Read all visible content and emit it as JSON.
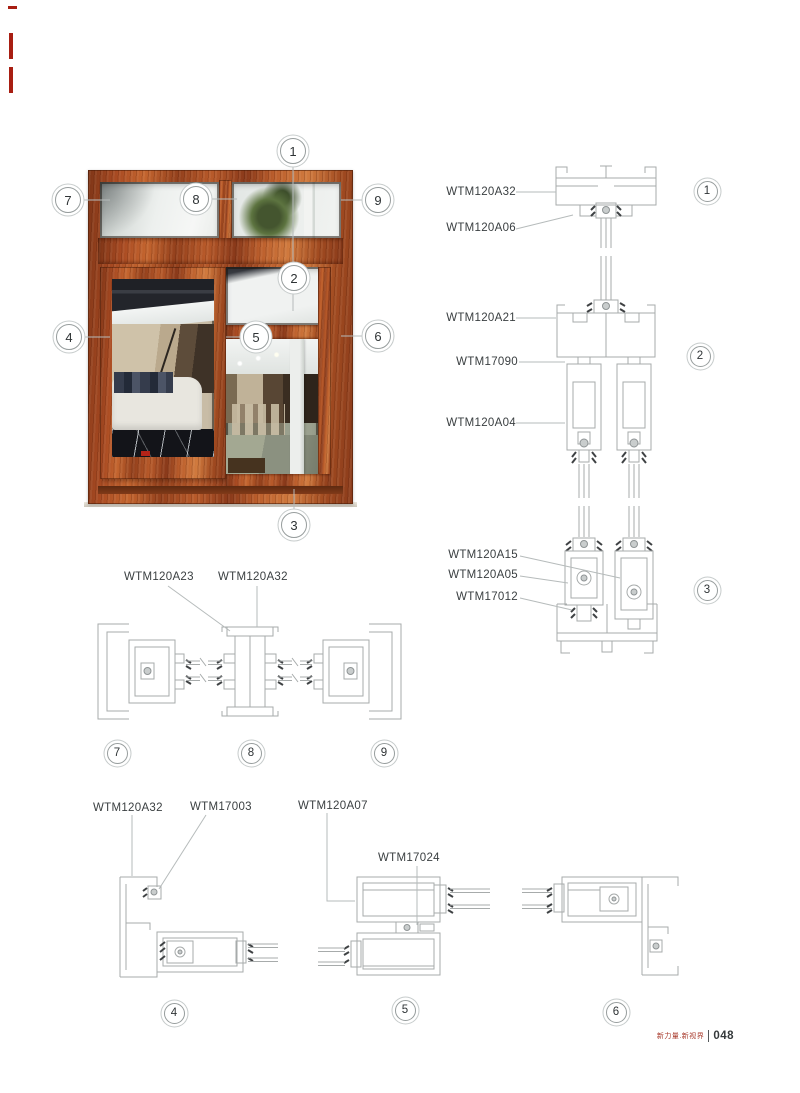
{
  "page": {
    "footer": {
      "brand": "新力量.新视界",
      "separator": "|",
      "page_number": "048"
    }
  },
  "window_photo": {
    "callouts": [
      "1",
      "2",
      "3",
      "4",
      "5",
      "6",
      "7",
      "8",
      "9"
    ]
  },
  "detail_sections": {
    "right_column": [
      {
        "callout": "1",
        "labels": [
          "WTM120A32",
          "WTM120A06"
        ]
      },
      {
        "callout": "2",
        "labels": [
          "WTM120A21",
          "WTM17090",
          "WTM120A04"
        ]
      },
      {
        "callout": "3",
        "labels": [
          "WTM120A15",
          "WTM120A05",
          "WTM17012"
        ]
      }
    ],
    "middle_row": {
      "labels": [
        "WTM120A23",
        "WTM120A32"
      ],
      "callouts": [
        "7",
        "8",
        "9"
      ]
    },
    "bottom_row": {
      "labels": [
        "WTM120A32",
        "WTM17003",
        "WTM120A07",
        "WTM17024"
      ],
      "callouts": [
        "4",
        "5",
        "6"
      ]
    }
  },
  "colors": {
    "wood": "#a9491f",
    "drawing_line": "#a7abab",
    "leader_line": "#b6bbbb",
    "label_text": "#3a3f41",
    "accent_red": "#a81e12"
  }
}
